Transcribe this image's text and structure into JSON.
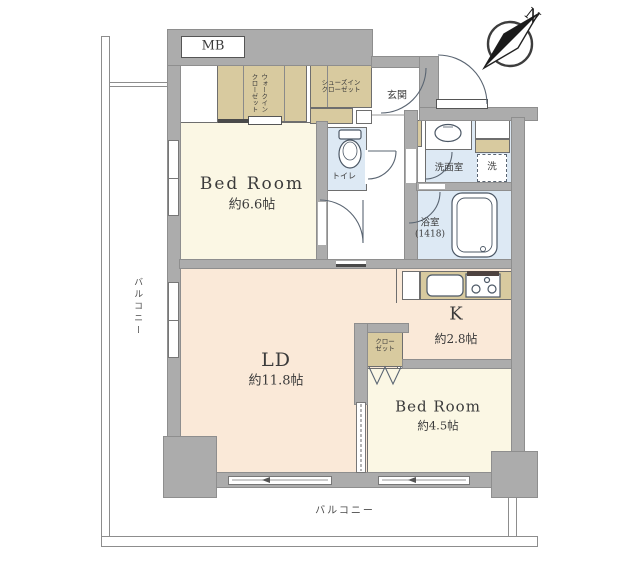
{
  "compass": {
    "label": "N"
  },
  "balcony": {
    "left_label": "バルコニー",
    "bottom_label": "バルコニー"
  },
  "rooms": {
    "bedroom_main": {
      "name": "Bed Room",
      "area": "約6.6帖"
    },
    "living_dining": {
      "name": "LD",
      "area": "約11.8帖"
    },
    "kitchen": {
      "name": "K",
      "area": "約2.8帖"
    },
    "bedroom_second": {
      "name": "Bed Room",
      "area": "約4.5帖"
    },
    "entrance": {
      "label": "玄関"
    },
    "toilet": {
      "label": "トイレ"
    },
    "washroom": {
      "label": "洗面室"
    },
    "bathroom": {
      "line1": "浴室",
      "line2": "(1418)"
    },
    "washer": {
      "label": "洗"
    },
    "meter_box": {
      "label": "MB"
    }
  },
  "storage": {
    "walk_in_closet": {
      "line1": "ウォークイン",
      "line2": "クローゼット"
    },
    "shoes_closet": {
      "line1": "シューズイン",
      "line2": "クローゼット"
    },
    "closet": {
      "line1": "クロー",
      "line2": "ゼット"
    }
  },
  "colors": {
    "wall": "#acacac",
    "cream": "#fbf7e4",
    "peach": "#fae9d8",
    "wet": "#dde9f4",
    "tan": "#d8ca9f",
    "line": "#6e6e6e",
    "ink": "#3b3b3b"
  }
}
